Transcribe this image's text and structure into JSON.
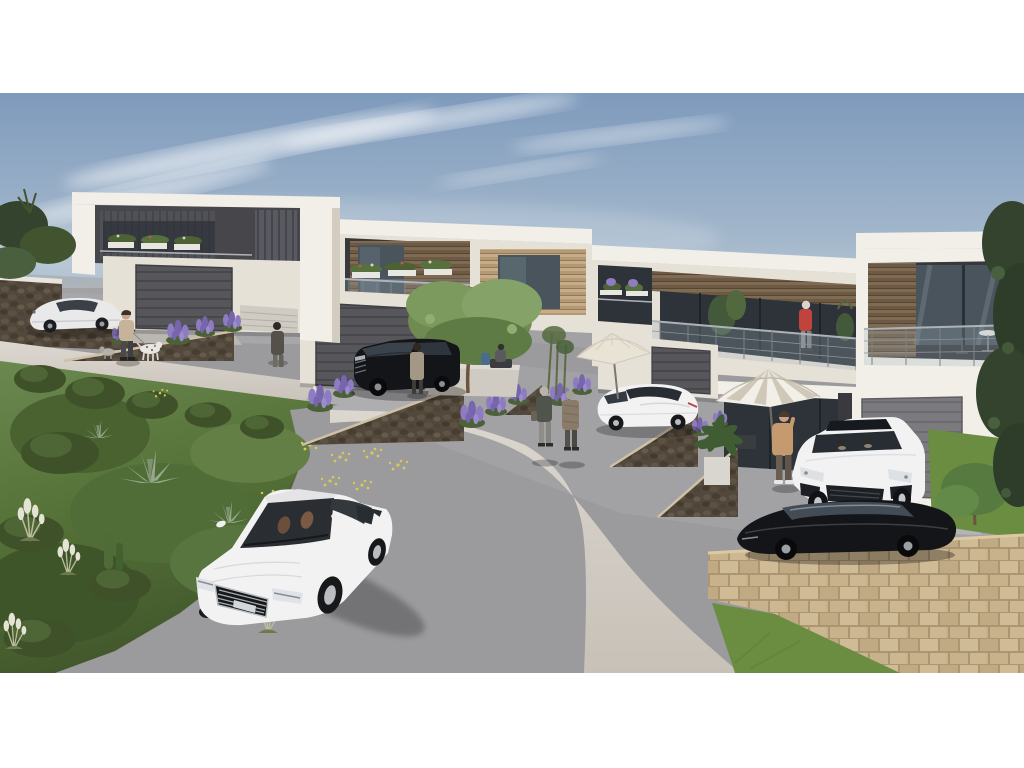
{
  "scene": {
    "type": "architectural-rendering",
    "subject": "modern-hillside-townhouse-development",
    "houses": [
      "charcoal-terrace-house",
      "cream-wood-balcony-house",
      "long-balcony-house",
      "white-glazed-balcony-house"
    ],
    "vehicles": [
      "silver-coupe-parked-left",
      "black-suv-driveway",
      "white-coupe-driveway",
      "white-suv-driveway",
      "black-sedan-right",
      "white-sedan-foreground"
    ],
    "people": [
      "dog-walker",
      "woman-by-lavender",
      "woman-by-suv",
      "elderly-couple-walking",
      "man-on-phone",
      "woman-on-balcony",
      "person-seated-by-door"
    ],
    "street_furniture": [
      "cream-patio-umbrella",
      "striped-patio-umbrella"
    ],
    "landscape": [
      "curved-road",
      "concrete-sidewalk-curve",
      "green-hill-planting",
      "stone-retaining-walls",
      "tan-block-wall",
      "lawn"
    ],
    "palette": {
      "sky-top": "#7e9abc",
      "sky-mid": "#a3b7cb",
      "sky-low": "#cdd8dd",
      "horizon-haze": "#e2e6e5",
      "cloud": "#ffffff",
      "wall-white": "#f1efe8",
      "wall-cream": "#e6e1d7",
      "wall-shade": "#d3cdc1",
      "charcoal": "#46464b",
      "charcoal-dark": "#37373c",
      "wood-dark": "#6e5a44",
      "wood-mid": "#7f6a52",
      "wood-light": "#b49a74",
      "glass-dark": "#2d3338",
      "glass-mid": "#49545c",
      "glass-tint": "#9fb0ba",
      "rib-dark": "#57565b",
      "rib-light": "#7b7a7f",
      "road": "#9b9a9d",
      "road-light": "#a7a6a9",
      "sidewalk": "#d4cfc7",
      "plateau": "#a2a1a4",
      "rubble": "#52483b",
      "stone": "#c8b28c",
      "grass": "#5b7840",
      "grass-dark": "#3f5429",
      "grass-light": "#7f9c57",
      "lawn": "#6a8d42",
      "foliage-dark": "#33432d",
      "tree-green": "#6f8b51",
      "lavender": "#8d7cc1",
      "flower-yellow": "#d9ca52",
      "pampas": "#e3e4d4",
      "car-white": "#f2f2f3",
      "car-black": "#141518",
      "car-silver": "#e9e9ea",
      "tan-jacket": "#c59a6e",
      "red-jacket": "#c0443c",
      "skin": "#c9a288"
    }
  }
}
